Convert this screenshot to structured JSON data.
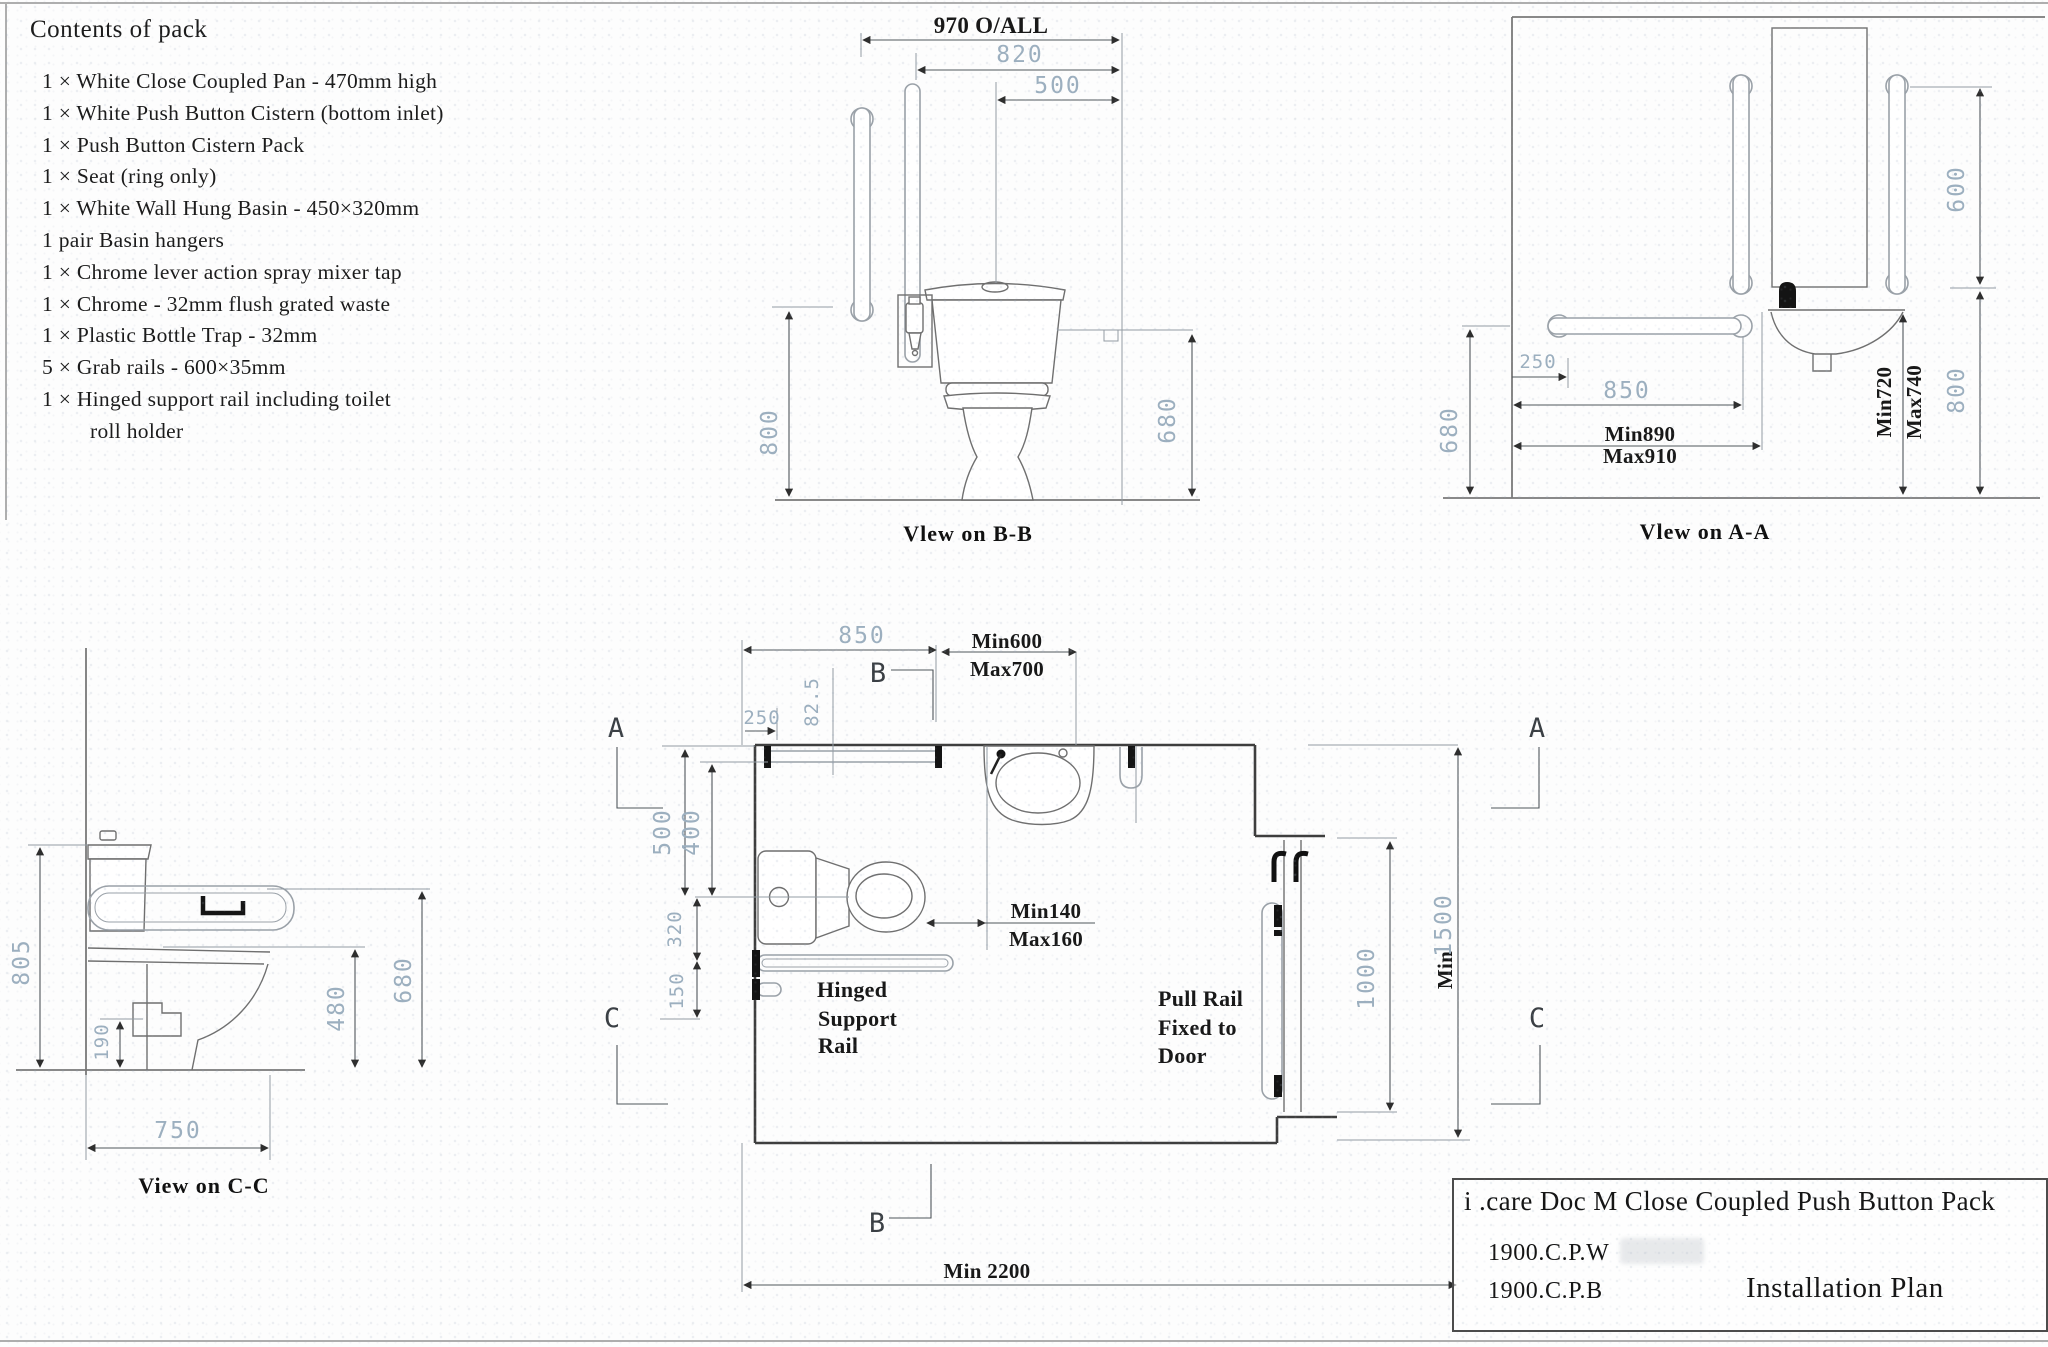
{
  "contents": {
    "heading": "Contents of pack",
    "items": [
      "1 × White Close Coupled Pan - 470mm high",
      "1 × White Push Button Cistern (bottom inlet)",
      "1 × Push Button Cistern Pack",
      "1 × Seat (ring only)",
      "1 × White Wall Hung Basin  - 450×320mm",
      "1 pair Basin hangers",
      "1 × Chrome lever action spray mixer tap",
      "1 × Chrome - 32mm flush grated waste",
      "1 × Plastic Bottle Trap -  32mm",
      "5 × Grab rails -  600×35mm",
      "1 × Hinged support rail including toilet",
      "roll holder"
    ]
  },
  "view_bb": {
    "caption": "Vlew on B-B",
    "dims": {
      "overall": "970 O/ALL",
      "width_820": "820",
      "width_500": "500",
      "height_800": "800",
      "height_680": "680"
    }
  },
  "view_aa": {
    "caption": "Vlew on A-A",
    "dims": {
      "rail_600": "600",
      "wall_250": "250",
      "rail_850": "850",
      "height_680": "680",
      "height_800": "800",
      "min_890": "Min890",
      "max_910": "Max910",
      "min_720": "Min720",
      "max_740": "Max740"
    }
  },
  "view_cc": {
    "caption": "View on C-C",
    "dims": {
      "height_805": "805",
      "height_190": "190",
      "height_480": "480",
      "height_680": "680",
      "depth_750": "750"
    }
  },
  "plan": {
    "dims": {
      "rail_850": "850",
      "offset_250": "250",
      "offset_825": "82.5",
      "min_600": "Min600",
      "max_700": "Max700",
      "d500": "500",
      "d400": "400",
      "d320": "320",
      "d150": "150",
      "min_140": "Min140",
      "max_160": "Max160",
      "door_1000": "1000",
      "min_label": "Min",
      "d1500": "1500",
      "min_2200": "Min 2200"
    },
    "labels": {
      "hinged_line1": "Hinged",
      "hinged_line2": "Support",
      "hinged_line3": "Rail",
      "pull_line1": "Pull Rail",
      "pull_line2": "Fixed to",
      "pull_line3": "Door"
    },
    "markers": {
      "a": "A",
      "b": "B",
      "c": "C"
    }
  },
  "title_block": {
    "product": "i .care Doc M Close Coupled Push Button Pack",
    "code_1": "1900.C.P.W",
    "code_2": "1900.C.P.B",
    "doc_title": "Installation Plan"
  }
}
